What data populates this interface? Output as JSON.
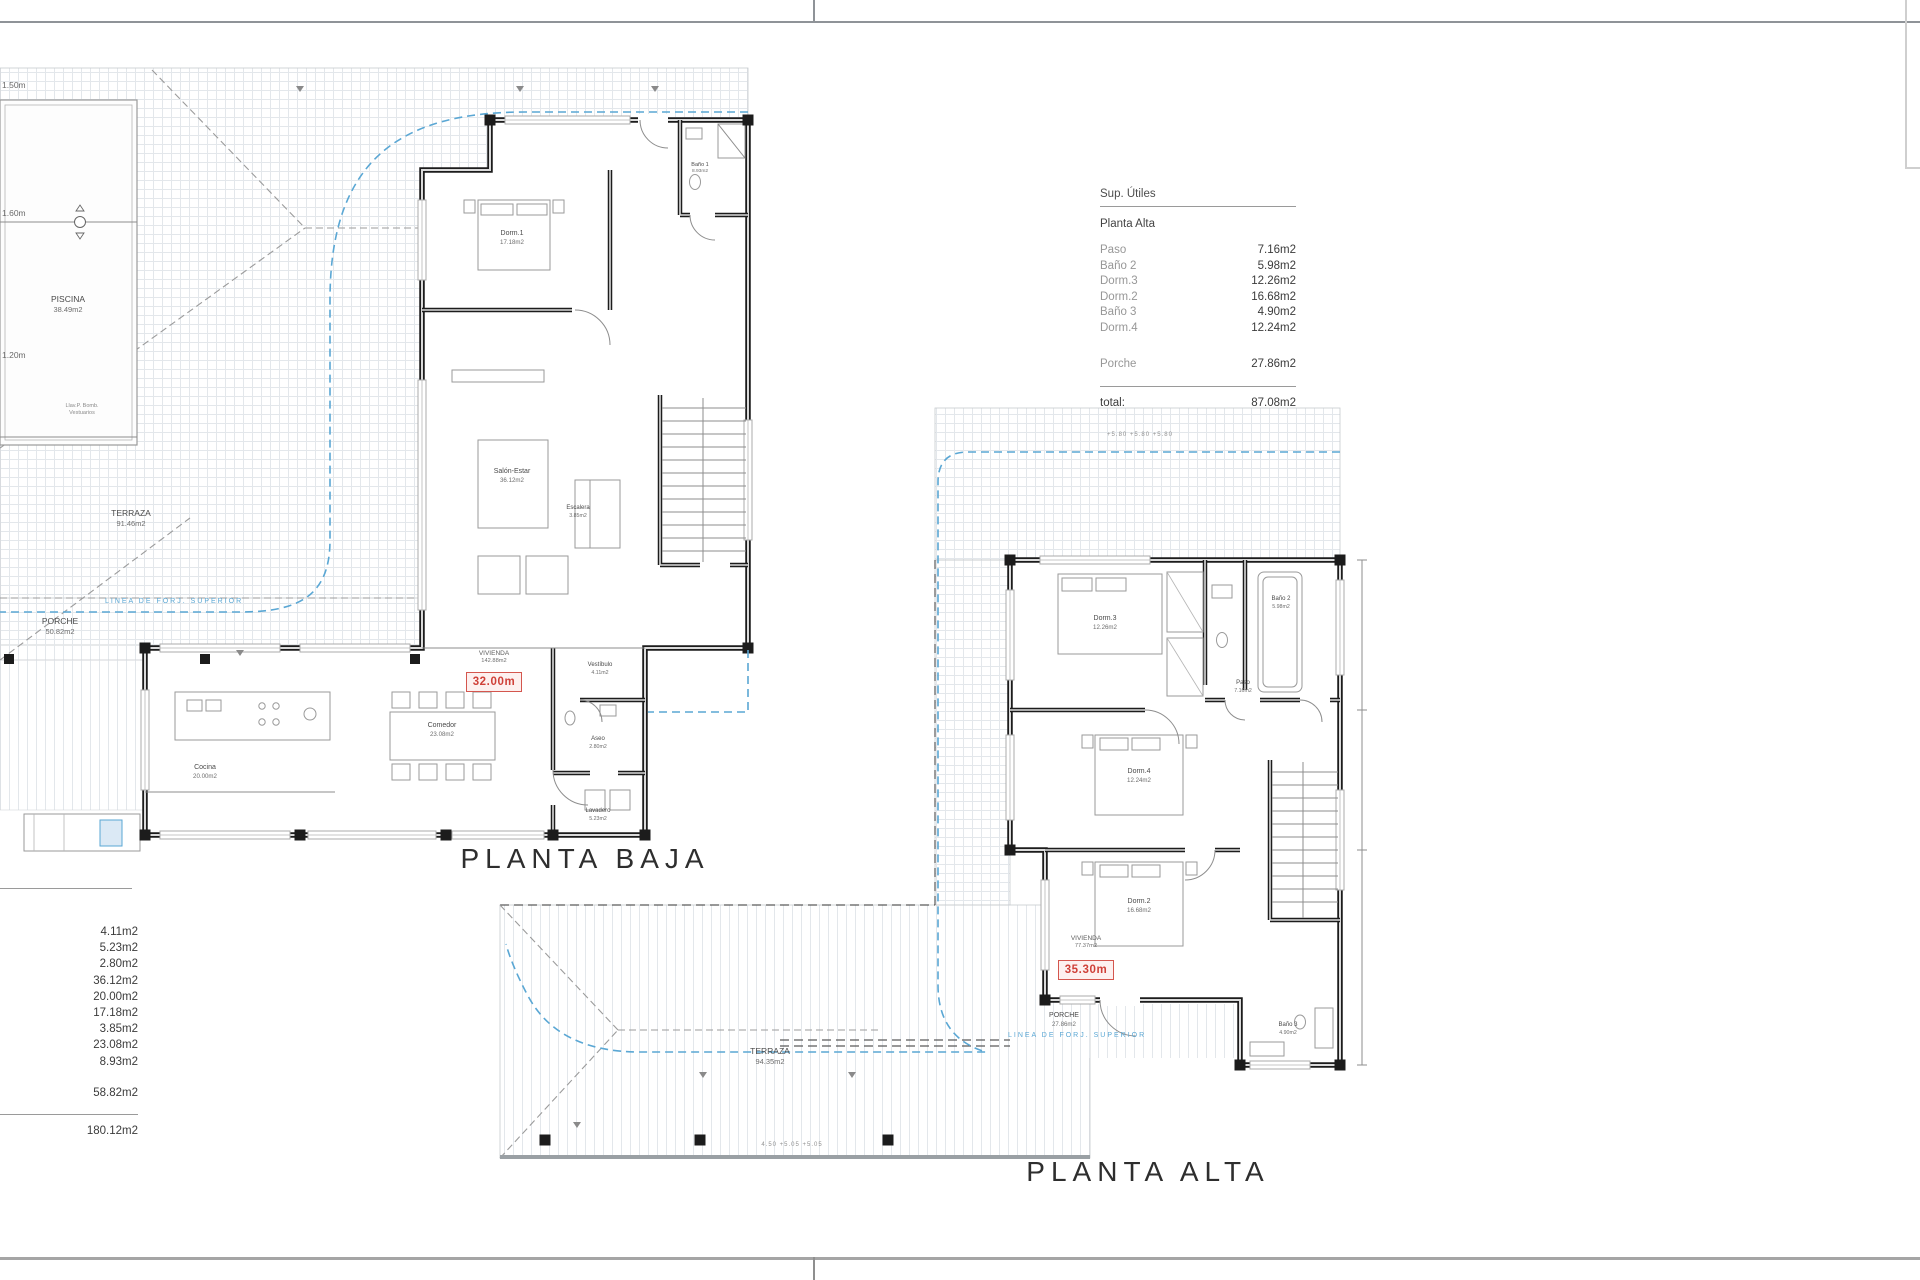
{
  "colors": {
    "blue_line": "#5aa7d4",
    "red_accent": "#cf4038",
    "wall": "#1c1c1c",
    "hatch": "#e3e7eb",
    "ink": "#3b3b3b",
    "muted": "#979797"
  },
  "titles": {
    "planta_baja": "PLANTA BAJA",
    "planta_alta": "PLANTA ALTA"
  },
  "sup_utiles": {
    "title": "Sup. Útiles",
    "section": "Planta Alta",
    "rows": [
      {
        "label": "Paso",
        "value": "7.16m2"
      },
      {
        "label": "Baño 2",
        "value": "5.98m2"
      },
      {
        "label": "Dorm.3",
        "value": "12.26m2"
      },
      {
        "label": "Dorm.2",
        "value": "16.68m2"
      },
      {
        "label": "Baño 3",
        "value": "4.90m2"
      },
      {
        "label": "Dorm.4",
        "value": "12.24m2"
      }
    ],
    "porche": {
      "label": "Porche",
      "value": "27.86m2"
    },
    "total_label": "total:",
    "total_value": "87.08m2"
  },
  "baja_table": {
    "values": [
      "4.11m2",
      "5.23m2",
      "2.80m2",
      "36.12m2",
      "20.00m2",
      "17.18m2",
      "3.85m2",
      "23.08m2",
      "8.93m2"
    ],
    "subtotal": "58.82m2",
    "total": "180.12m2"
  },
  "baja": {
    "piscina": "PISCINA",
    "piscina_area": "38.49m2",
    "terraza": "TERRAZA",
    "terraza_area": "91.46m2",
    "porche": "PORCHE",
    "porche_area": "50.82m2",
    "linea": "LINEA DE FORJ. SUPERIOR",
    "d150": "1.50m",
    "d160": "1.60m",
    "d120": "1.20m",
    "note1": "Llav.P. Bomb.",
    "note2": "Vestuarios",
    "dorm1": "Dorm.1",
    "dorm1_area": "17.18m2",
    "salon": "Salón-Estar",
    "salon_area": "36.12m2",
    "comedor": "Comedor",
    "comedor_area": "23.08m2",
    "cocina": "Cocina",
    "cocina_area": "20.00m2",
    "vestibulo": "Vestíbulo",
    "vestibulo_area": "4.11m2",
    "aseo": "Aseo",
    "aseo_area": "2.80m2",
    "lavadero": "Lavadero",
    "lavadero_area": "5.23m2",
    "escalera": "Escalera",
    "escalera_area": "3.85m2",
    "bano1": "Baño 1",
    "bano1_area": "8.93m2",
    "vivienda": "VIVIENDA",
    "vivienda_area": "142.88m2",
    "dim": "32.00m"
  },
  "alta": {
    "dorm3": "Dorm.3",
    "dorm3_area": "12.26m2",
    "dorm4": "Dorm.4",
    "dorm4_area": "12.24m2",
    "dorm2": "Dorm.2",
    "dorm2_area": "16.68m2",
    "bano2": "Baño 2",
    "bano2_area": "5.98m2",
    "bano3": "Baño 3",
    "bano3_area": "4.90m2",
    "paso": "Paso",
    "paso_area": "7.16m2",
    "porche": "PORCHE",
    "porche_area": "27.86m2",
    "terraza": "TERRAZA",
    "terraza_area": "94.35m2",
    "linea": "LINEA DE FORJ. SUPERIOR",
    "dims_top": "+5.80   +5.80   +5.80",
    "dims_bottom": "4.50   +5.05   +5.05",
    "vivienda": "VIVIENDA",
    "vivienda_area": "77.37m2",
    "dim": "35.30m"
  }
}
